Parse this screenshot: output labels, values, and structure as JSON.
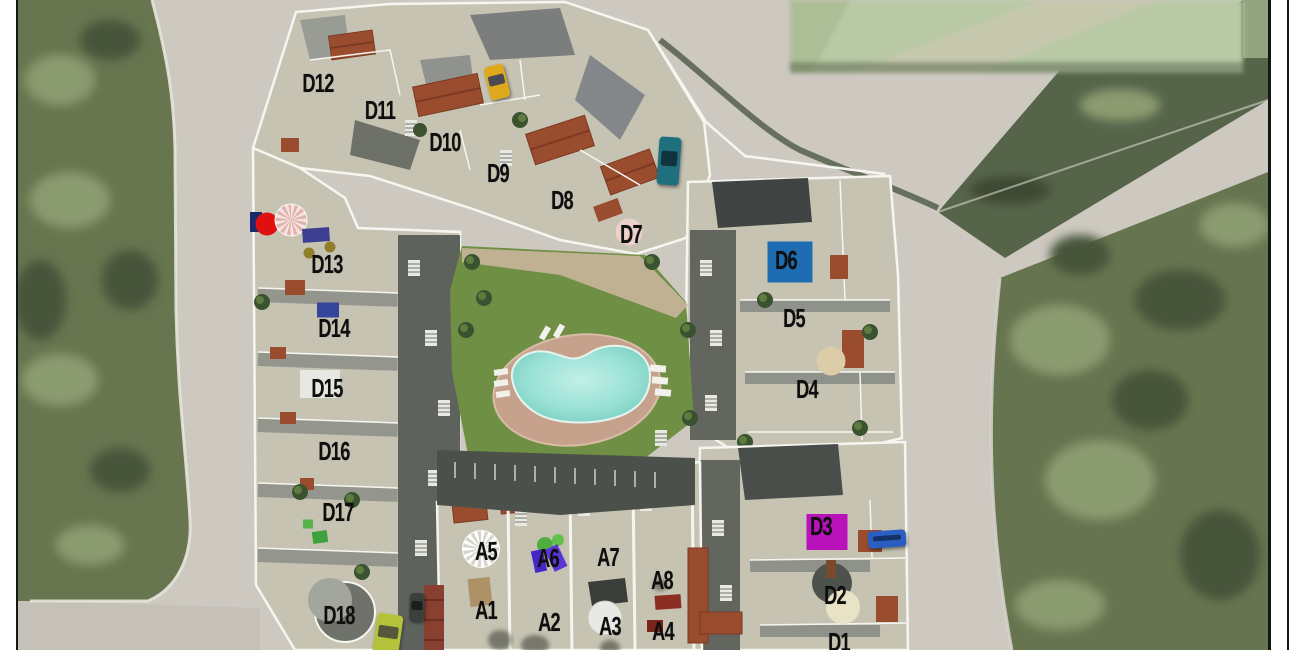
{
  "document": {
    "description": "Aerial 3D-render site plan of a residential development with numbered unit blocks",
    "border_color": "#161616",
    "margin_color": "#ffffff"
  },
  "palette": {
    "road": "#cdc9c1",
    "scrub_green": "#67764f",
    "scrub_light": "#8b9b70",
    "scrub_dark": "#47553a",
    "pasted_patch_green": "#b8c9a4",
    "building_beige": "#c7c3b3",
    "wall_white": "#f6f6f1",
    "roof_terracotta": "#9a4c2e",
    "lawn_green": "#6f8f44",
    "deck_tan": "#c6a28c",
    "pool_aqua": "#8adbcf",
    "shadow_gray": "#5e625c",
    "label_black": "#0e0e0e"
  },
  "units": [
    {
      "id": "D1",
      "x": 839,
      "y": 642
    },
    {
      "id": "D2",
      "x": 835,
      "y": 595
    },
    {
      "id": "D3",
      "x": 821,
      "y": 526
    },
    {
      "id": "D4",
      "x": 807,
      "y": 389
    },
    {
      "id": "D5",
      "x": 794,
      "y": 318
    },
    {
      "id": "D6",
      "x": 786,
      "y": 260
    },
    {
      "id": "D7",
      "x": 631,
      "y": 234
    },
    {
      "id": "D8",
      "x": 562,
      "y": 200
    },
    {
      "id": "D9",
      "x": 498,
      "y": 173
    },
    {
      "id": "D10",
      "x": 445,
      "y": 142
    },
    {
      "id": "D11",
      "x": 380,
      "y": 110
    },
    {
      "id": "D12",
      "x": 318,
      "y": 83
    },
    {
      "id": "D13",
      "x": 327,
      "y": 264
    },
    {
      "id": "D14",
      "x": 334,
      "y": 328
    },
    {
      "id": "D15",
      "x": 327,
      "y": 388
    },
    {
      "id": "D16",
      "x": 334,
      "y": 451
    },
    {
      "id": "D17",
      "x": 338,
      "y": 512
    },
    {
      "id": "D18",
      "x": 339,
      "y": 615
    },
    {
      "id": "A1",
      "x": 486,
      "y": 610
    },
    {
      "id": "A2",
      "x": 549,
      "y": 622
    },
    {
      "id": "A3",
      "x": 610,
      "y": 626
    },
    {
      "id": "A4",
      "x": 663,
      "y": 631
    },
    {
      "id": "A5",
      "x": 486,
      "y": 551
    },
    {
      "id": "A6",
      "x": 548,
      "y": 558
    },
    {
      "id": "A7",
      "x": 608,
      "y": 557
    },
    {
      "id": "A8",
      "x": 662,
      "y": 580
    }
  ],
  "markers": [
    {
      "name": "navy-windbreak",
      "shape": "rect",
      "x": 256,
      "y": 222,
      "w": 12,
      "h": 20,
      "rot": 0,
      "color": "#1a2a6a",
      "style": "solid"
    },
    {
      "name": "red-parasol",
      "shape": "circle",
      "x": 267,
      "y": 224,
      "w": 23,
      "h": 23,
      "rot": 0,
      "color": "#e01010",
      "style": "solid"
    },
    {
      "name": "pink-spiral-parasol",
      "shape": "circle",
      "x": 291,
      "y": 220,
      "w": 31,
      "h": 31,
      "rot": 0,
      "color": "",
      "style": "spiral-pink"
    },
    {
      "name": "navy-pergola",
      "shape": "rect",
      "x": 316,
      "y": 235,
      "w": 27,
      "h": 14,
      "rot": -4,
      "color": "#3d3d92",
      "style": "solid"
    },
    {
      "name": "olive-table-a",
      "shape": "circle",
      "x": 330,
      "y": 247,
      "w": 11,
      "h": 11,
      "rot": 0,
      "color": "#8f7f2a",
      "style": "solid"
    },
    {
      "name": "olive-table-b",
      "shape": "circle",
      "x": 309,
      "y": 253,
      "w": 11,
      "h": 11,
      "rot": 0,
      "color": "#8f7f2a",
      "style": "solid"
    },
    {
      "name": "blue-spa-d14",
      "shape": "rect",
      "x": 328,
      "y": 310,
      "w": 22,
      "h": 15,
      "rot": 0,
      "color": "#35459c",
      "style": "solid"
    },
    {
      "name": "pink-parasol-d7",
      "shape": "circle",
      "x": 629,
      "y": 232,
      "w": 27,
      "h": 27,
      "rot": 0,
      "color": "#ecd0ca",
      "style": "solid"
    },
    {
      "name": "blue-roof-pool-d6",
      "shape": "rect",
      "x": 790,
      "y": 262,
      "w": 45,
      "h": 41,
      "rot": 0,
      "color": "#1e6cb2",
      "style": "solid"
    },
    {
      "name": "tan-parasol-d4",
      "shape": "circle",
      "x": 831,
      "y": 361,
      "w": 29,
      "h": 29,
      "rot": 0,
      "color": "#dccca8",
      "style": "solid"
    },
    {
      "name": "magenta-roof-d3",
      "shape": "rect",
      "x": 827,
      "y": 532,
      "w": 41,
      "h": 36,
      "rot": 0,
      "color": "#ba12ba",
      "style": "solid"
    },
    {
      "name": "cream-parasol-d2",
      "shape": "circle",
      "x": 843,
      "y": 607,
      "w": 34,
      "h": 34,
      "rot": 0,
      "color": "#e9e3c6",
      "style": "solid"
    },
    {
      "name": "white-spiral-parasol-a5",
      "shape": "circle",
      "x": 481,
      "y": 549,
      "w": 36,
      "h": 36,
      "rot": 0,
      "color": "",
      "style": "spiral-white"
    },
    {
      "name": "purple-lounger-a",
      "shape": "rect",
      "x": 539,
      "y": 561,
      "w": 12,
      "h": 22,
      "rot": -12,
      "color": "#4526c8",
      "style": "solid"
    },
    {
      "name": "purple-lounger-b",
      "shape": "rect",
      "x": 556,
      "y": 558,
      "w": 14,
      "h": 24,
      "rot": -25,
      "color": "#5a35d5",
      "style": "solid"
    },
    {
      "name": "green-lounge-d17",
      "shape": "rect",
      "x": 320,
      "y": 537,
      "w": 15,
      "h": 12,
      "rot": -8,
      "color": "#3da23d",
      "style": "solid"
    },
    {
      "name": "green-chair-d17",
      "shape": "rect",
      "x": 308,
      "y": 524,
      "w": 10,
      "h": 9,
      "rot": 0,
      "color": "#56b34a",
      "style": "solid"
    },
    {
      "name": "red-table-a4",
      "shape": "rect",
      "x": 668,
      "y": 602,
      "w": 26,
      "h": 14,
      "rot": -4,
      "color": "#8a2e22",
      "style": "solid"
    },
    {
      "name": "red-chair-a4",
      "shape": "rect",
      "x": 655,
      "y": 626,
      "w": 16,
      "h": 12,
      "rot": 0,
      "color": "#7a241a",
      "style": "solid"
    },
    {
      "name": "tan-pergola-a1",
      "shape": "rect",
      "x": 480,
      "y": 592,
      "w": 22,
      "h": 28,
      "rot": -6,
      "color": "#ad9268",
      "style": "solid"
    }
  ],
  "vehicles": [
    {
      "name": "yellow-car",
      "x": 497,
      "y": 82,
      "w": 20,
      "h": 34,
      "rot": -14,
      "color": "#dfa91e",
      "glass": "#4a4a55"
    },
    {
      "name": "teal-car",
      "x": 669,
      "y": 161,
      "w": 22,
      "h": 48,
      "rot": 4,
      "color": "#1f6f7e",
      "glass": "#10343c"
    },
    {
      "name": "blue-truck",
      "x": 887,
      "y": 539,
      "w": 38,
      "h": 17,
      "rot": -4,
      "color": "#2a5ec2",
      "glass": "#16306a"
    },
    {
      "name": "lime-car",
      "x": 388,
      "y": 634,
      "w": 26,
      "h": 40,
      "rot": 8,
      "color": "#b5c23c",
      "glass": "#55583a"
    },
    {
      "name": "dark-car",
      "x": 417,
      "y": 607,
      "w": 15,
      "h": 28,
      "rot": 2,
      "color": "#3c3f3c",
      "glass": "#1d1f1d"
    }
  ]
}
